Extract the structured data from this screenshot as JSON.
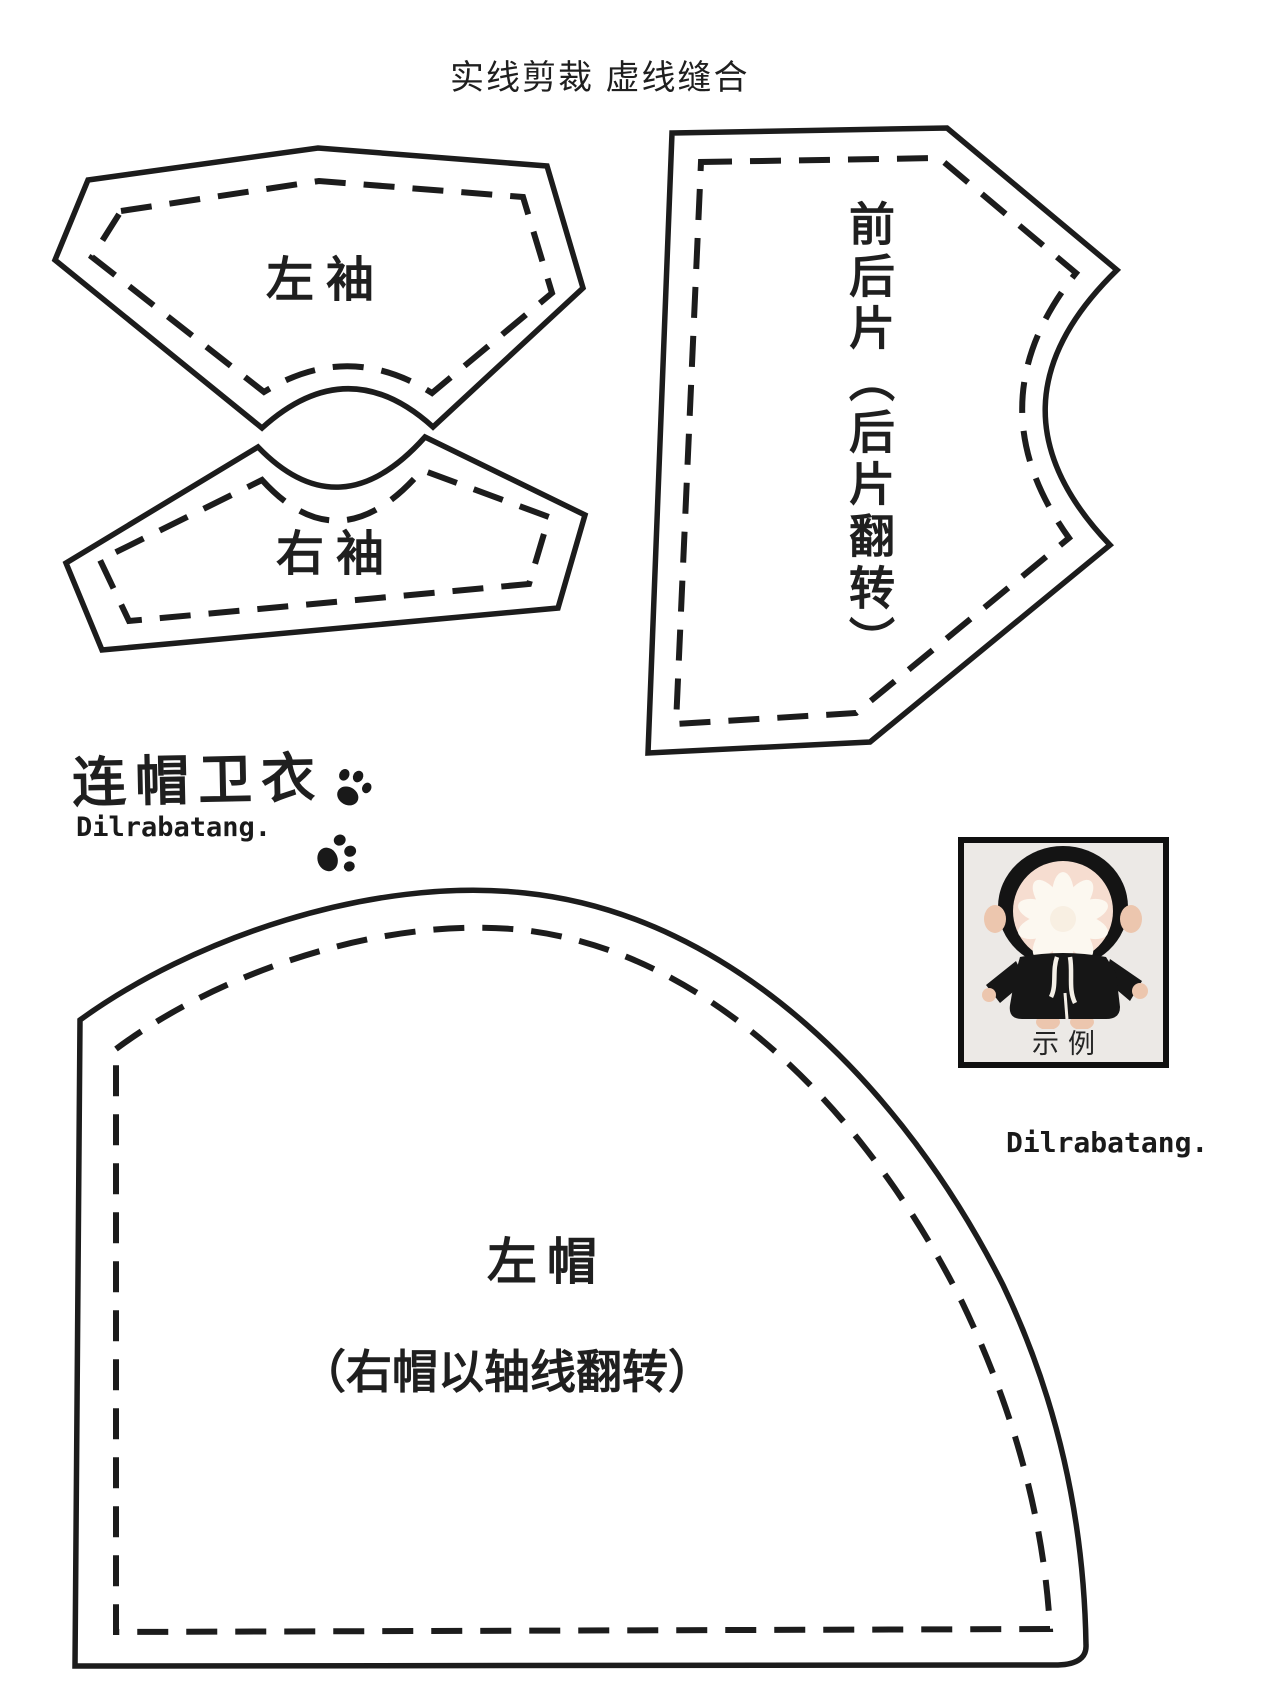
{
  "legend": {
    "title": "实线剪裁 虚线缝合"
  },
  "pieces": {
    "left_sleeve": {
      "label": "左袖"
    },
    "right_sleeve": {
      "label": "右袖"
    },
    "front_back": {
      "label": "前后片（后片翻转）"
    },
    "hood": {
      "label": "左帽",
      "sublabel": "（右帽以轴线翻转）"
    }
  },
  "branding": {
    "pattern_name": "连帽卫衣",
    "signature_left": "Dilrabatang.",
    "signature_right": "Dilrabatang."
  },
  "example_photo": {
    "caption": "示例"
  },
  "icons": {
    "paw_prints": "paw-print-icon",
    "example_doll": "doll-example-photo"
  },
  "colors": {
    "line": "#1c1c1c",
    "background": "#ffffff",
    "photo_background": "#ece9e6",
    "doll_jacket": "#161616",
    "doll_skin": "#ecc6ae"
  }
}
